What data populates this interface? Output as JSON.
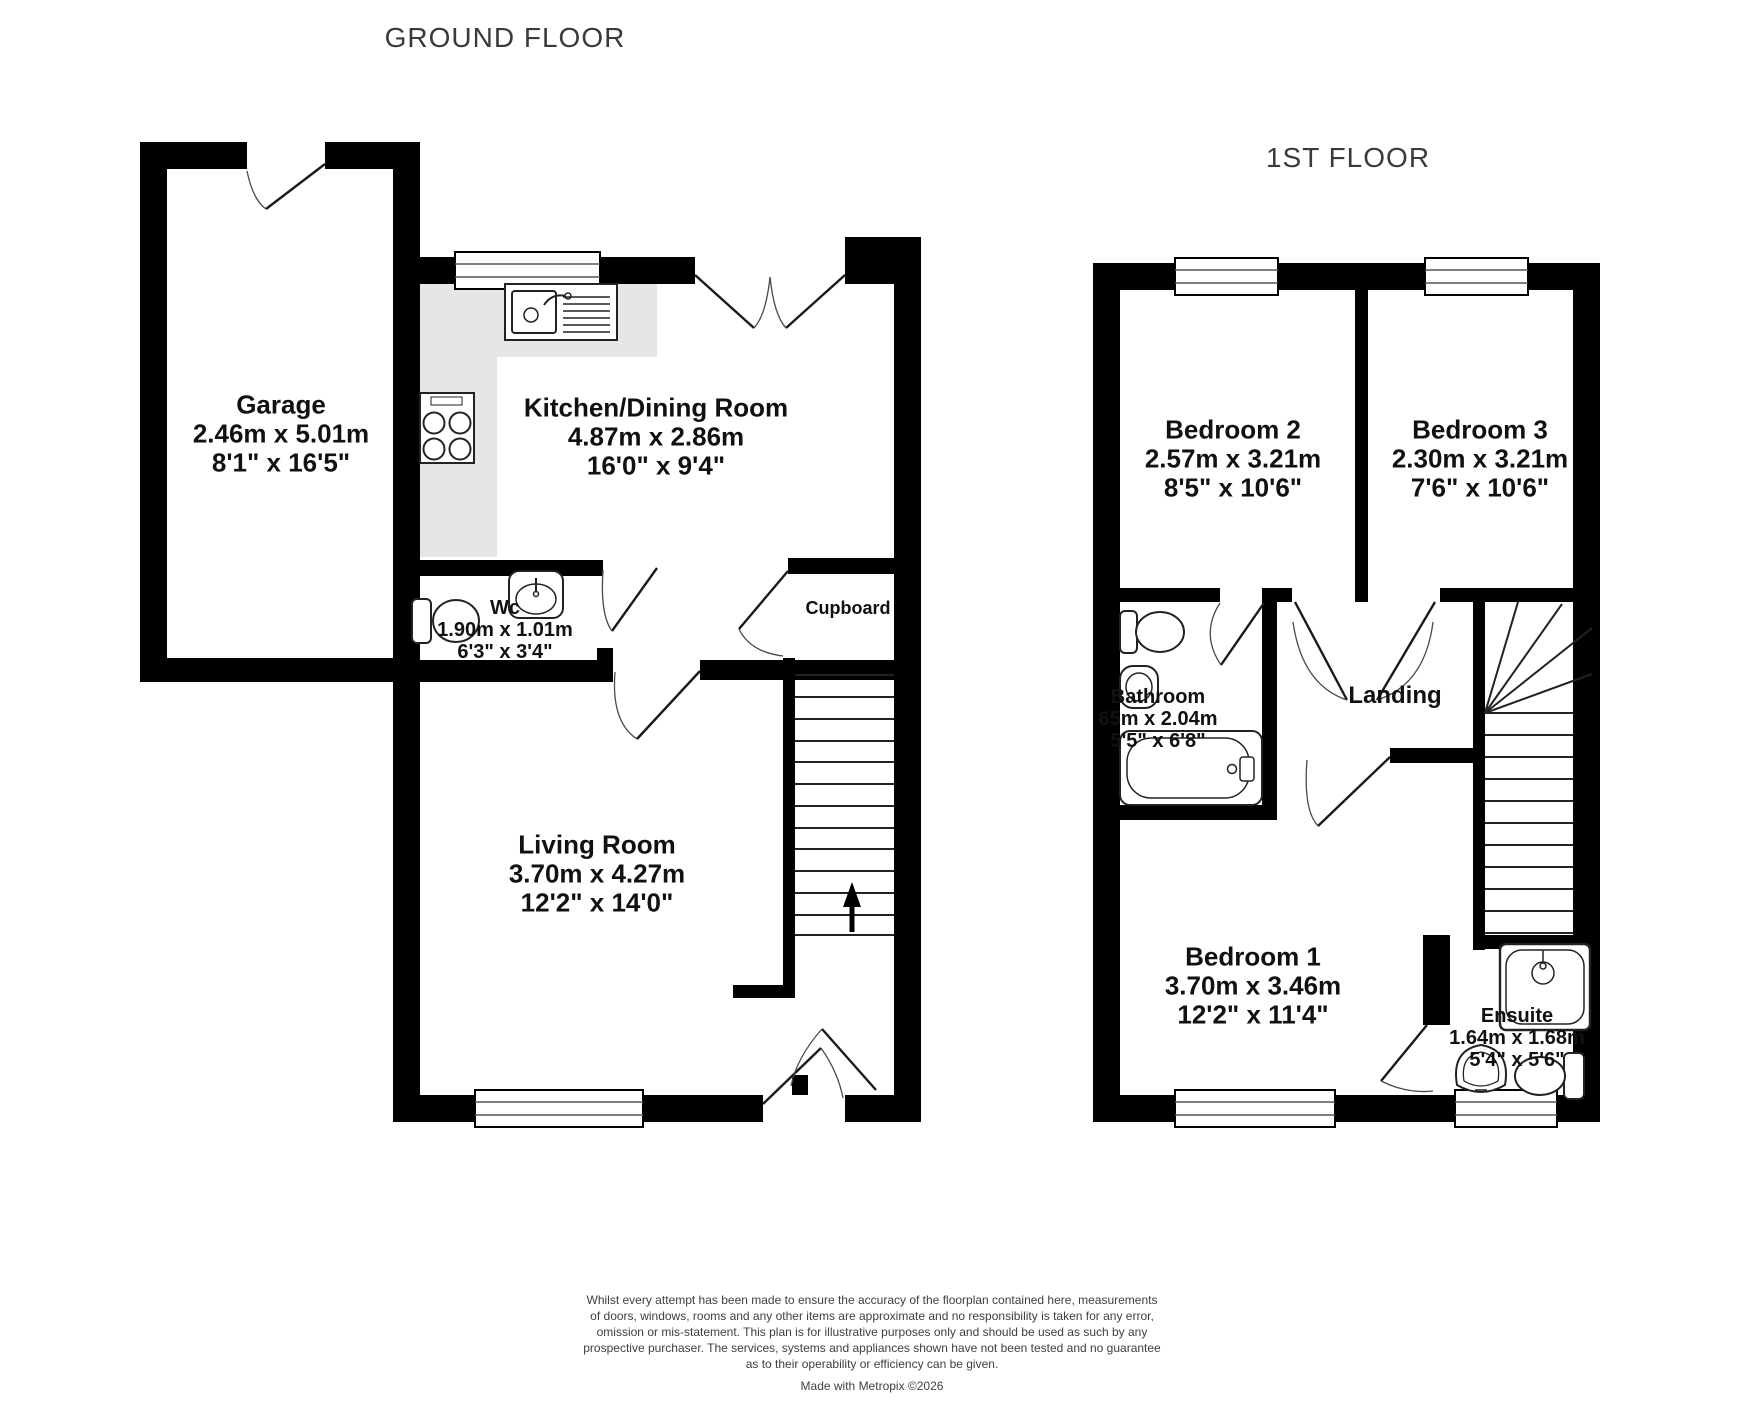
{
  "ground_floor": {
    "title": "GROUND FLOOR",
    "garage": {
      "name": "Garage",
      "metric": "2.46m x 5.01m",
      "imperial": "8'1\" x 16'5\""
    },
    "kitchen": {
      "name": "Kitchen/Dining Room",
      "metric": "4.87m x 2.86m",
      "imperial": "16'0\" x 9'4\""
    },
    "wc": {
      "name": "Wc",
      "metric": "1.90m x 1.01m",
      "imperial": "6'3\" x 3'4\""
    },
    "cupboard": {
      "name": "Cupboard"
    },
    "living": {
      "name": "Living Room",
      "metric": "3.70m x 4.27m",
      "imperial": "12'2\" x 14'0\""
    }
  },
  "first_floor": {
    "title": "1ST FLOOR",
    "bedroom2": {
      "name": "Bedroom 2",
      "metric": "2.57m x 3.21m",
      "imperial": "8'5\" x 10'6\""
    },
    "bedroom3": {
      "name": "Bedroom 3",
      "metric": "2.30m x 3.21m",
      "imperial": "7'6\" x 10'6\""
    },
    "bathroom": {
      "name": "Bathroom",
      "metric": "65m x 2.04m",
      "imperial": "5'5\" x 6'8\""
    },
    "landing": {
      "name": "Landing"
    },
    "bedroom1": {
      "name": "Bedroom 1",
      "metric": "3.70m x 3.46m",
      "imperial": "12'2\" x 11'4\""
    },
    "ensuite": {
      "name": "Ensuite",
      "metric": "1.64m x 1.68m",
      "imperial": "5'4\" x 5'6\""
    }
  },
  "footer": {
    "disclaimer_lines": [
      "Whilst every attempt has been made to ensure the accuracy of the floorplan contained here, measurements",
      "of doors, windows, rooms and any other items are approximate and no responsibility is taken for any error,",
      "omission or mis-statement. This plan is for illustrative purposes only and should be used as such by any",
      "prospective purchaser. The services, systems and appliances shown have not been tested and no guarantee",
      "as to their operability or efficiency can be given."
    ],
    "credit": "Made with Metropix ©2026"
  },
  "colors": {
    "wall": "#000000",
    "counter": "#e6e6e6",
    "title_text": "#3a3a3a"
  }
}
